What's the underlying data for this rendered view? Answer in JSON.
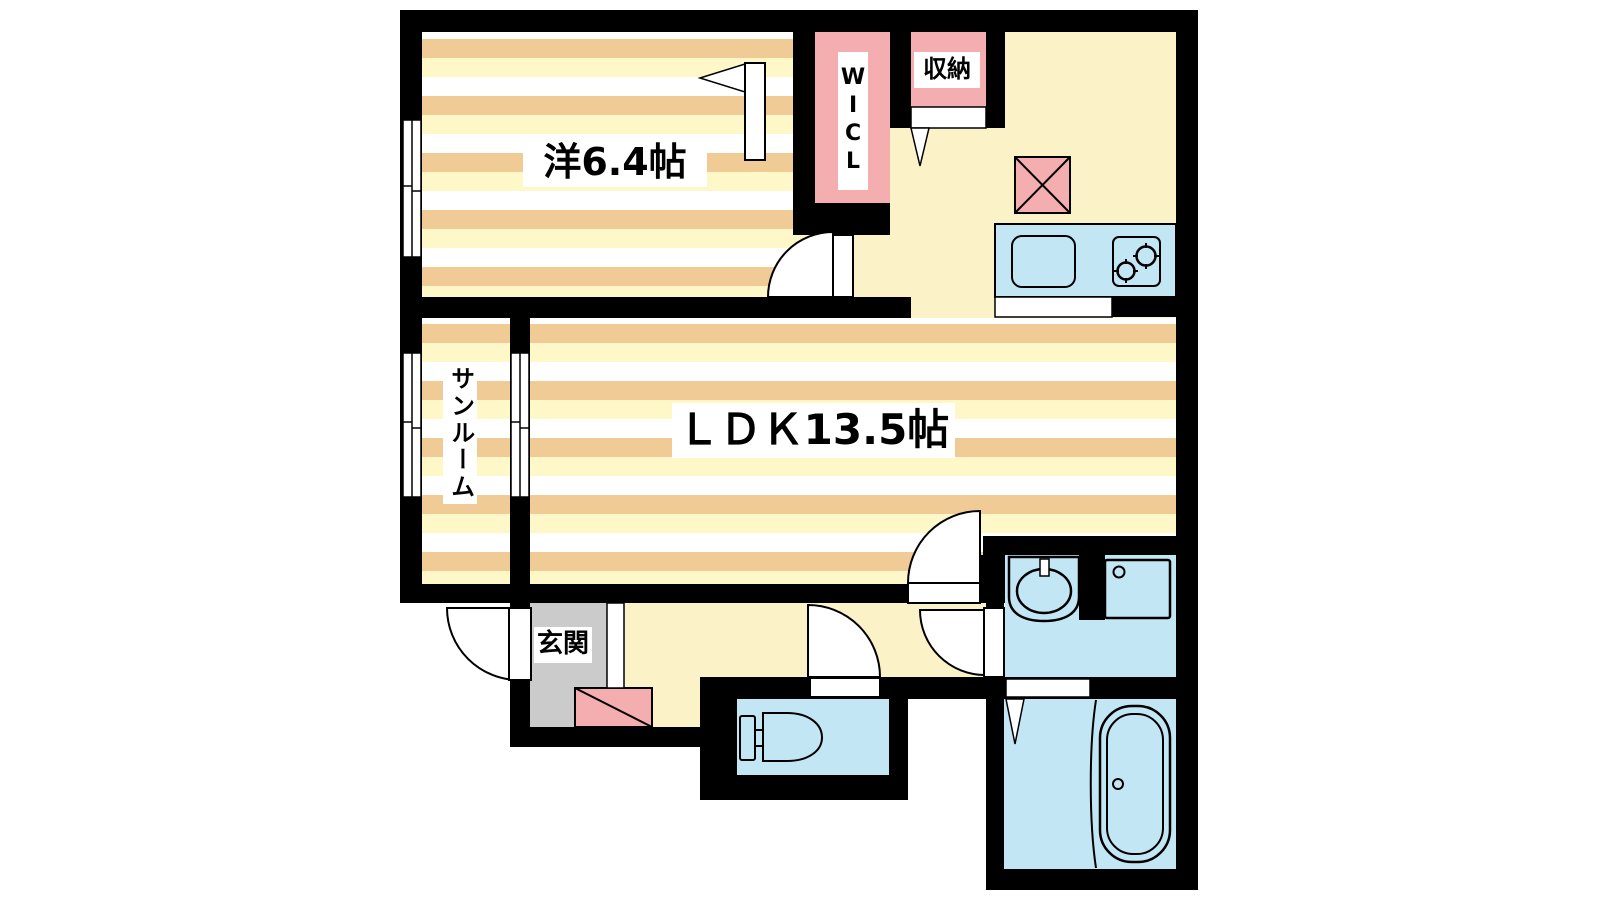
{
  "plan": {
    "type": "apartment-floor-plan",
    "rooms": {
      "bedroom": {
        "label": "洋6.4帖"
      },
      "ldk": {
        "label": "ＬＤＫ13.5帖"
      },
      "sunroom": {
        "label": "サンルーム"
      },
      "entrance": {
        "label": "玄関"
      },
      "wic": {
        "label": "WICL"
      },
      "storage": {
        "label": "収納"
      }
    },
    "fixtures": [
      "refrigerator-space",
      "kitchen-sink",
      "gas-stove-2-burner",
      "toilet",
      "vanity-sink",
      "washing-machine-pan",
      "bathtub",
      "shoe-cabinet",
      "entry-step"
    ],
    "windows": [
      "bedroom-west-window",
      "sunroom-west-window",
      "sunroom-ldk-window"
    ],
    "doors": [
      "entry-door",
      "bedroom-kitchen-door",
      "wic-door",
      "storage-door",
      "ldk-hall-door",
      "toilet-door",
      "washroom-door",
      "bath-sliding-door",
      "bath-folding-door"
    ],
    "colors": {
      "wall": "#000000",
      "stripe_tan": "#F1CB95",
      "stripe_cream": "#FEF7C8",
      "floor_yellow": "#FBF2C8",
      "water_blue": "#C3E6F5",
      "closet_pink": "#F5AEAF",
      "entrance_gray": "#CBCBCB",
      "exterior": "#FFFFFF"
    }
  }
}
